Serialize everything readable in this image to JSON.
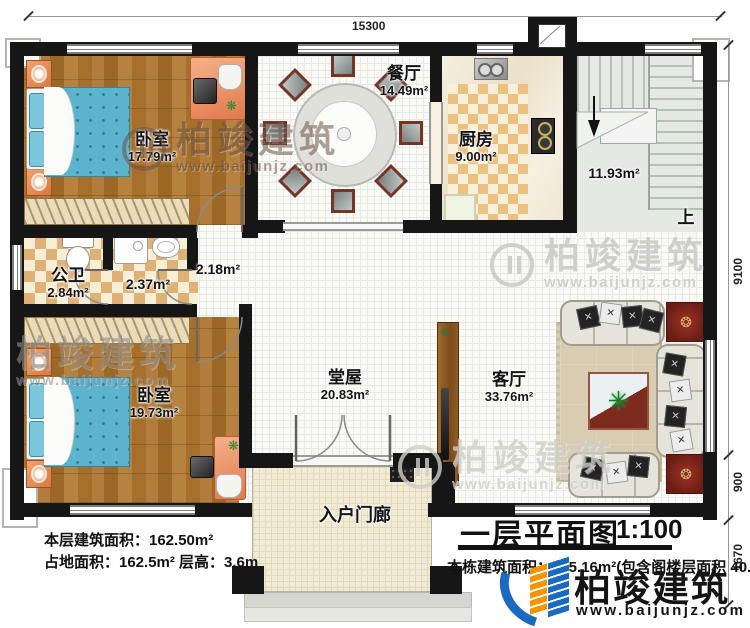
{
  "dimensions": {
    "top_width": "15300",
    "right_main": "9100",
    "right_lower": "900",
    "right_porch": "1670"
  },
  "rooms": {
    "bedroom_top": {
      "label": "卧室",
      "area": "17.79m²"
    },
    "bathroom": {
      "label": "公卫",
      "area": "2.84m²"
    },
    "laundry_area": {
      "area": "2.37m²"
    },
    "corridor": {
      "area": "2.18m²"
    },
    "bedroom_bottom": {
      "label": "卧室",
      "area": "19.73m²"
    },
    "dining": {
      "label": "餐厅",
      "area": "14.49m²"
    },
    "kitchen": {
      "label": "厨房",
      "area": "9.00m²"
    },
    "stairwell": {
      "area": "11.93m²",
      "up": "上"
    },
    "hall": {
      "label": "堂屋",
      "area": "20.83m²"
    },
    "living": {
      "label": "客厅",
      "area": "33.76m²"
    },
    "porch": {
      "label": "入户门廊"
    }
  },
  "title": {
    "name": "一层平面图",
    "scale": "1:100"
  },
  "stats": {
    "floor_area": "本层建筑面积：162.50m²",
    "site_area": "占地面积：162.5m² 层高：3.6m",
    "total_area": "本栋建筑面积：325.16m²(包含阁楼层面积 40.79m²)"
  },
  "brand": {
    "name": "柏竣建筑",
    "url": "www.baijunjz.com"
  }
}
